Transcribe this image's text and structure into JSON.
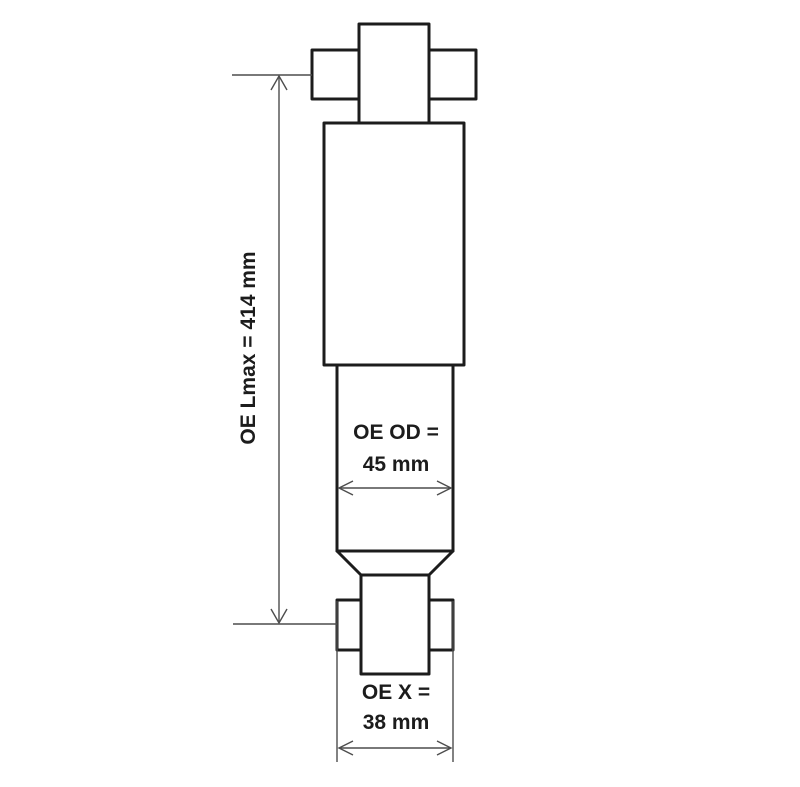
{
  "diagram": {
    "type": "technical-dimension-drawing",
    "subject": "shock absorber",
    "colors": {
      "background": "#ffffff",
      "part_outline": "#1c1c1c",
      "dimension_lines": "#4d4d4d",
      "text": "#1c1c1c"
    },
    "dimensions": {
      "lmax_label": "OE Lmax = 414 mm",
      "od_label_line1": "OE OD =",
      "od_label_line2": "45 mm",
      "x_label_line1": "OE X =",
      "x_label_line2": "38 mm"
    }
  }
}
